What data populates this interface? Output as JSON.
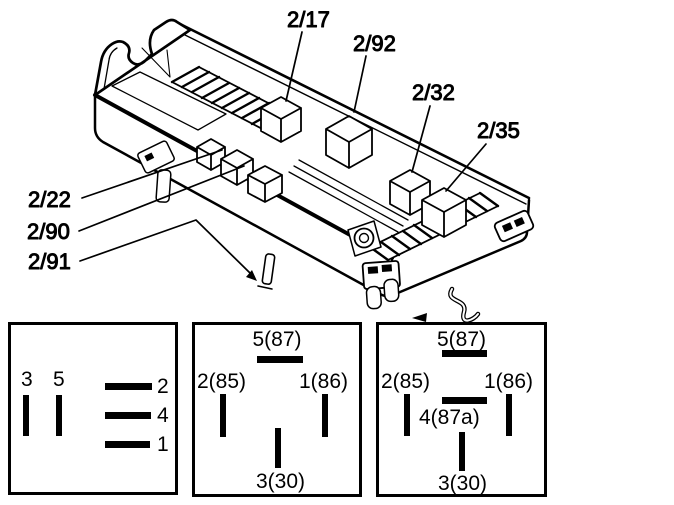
{
  "figure": {
    "type": "relay-box-diagram",
    "background": "#ffffff",
    "line_color": "#000000"
  },
  "callouts": [
    {
      "label": "2/17"
    },
    {
      "label": "2/92"
    },
    {
      "label": "2/32"
    },
    {
      "label": "2/35"
    },
    {
      "label": "2/22"
    },
    {
      "label": "2/90"
    },
    {
      "label": "2/91"
    }
  ],
  "pinouts": [
    {
      "name": "pin-profile-socket",
      "left_pins": [
        "3",
        "5"
      ],
      "right_pins": [
        "2",
        "4",
        "1"
      ]
    },
    {
      "name": "relay-base-4-pin",
      "top": "5(87)",
      "left": "2(85)",
      "right": "1(86)",
      "bottom": "3(30)"
    },
    {
      "name": "relay-base-5-pin",
      "top": "5(87)",
      "left": "2(85)",
      "right": "1(86)",
      "middle": "4(87a)",
      "bottom": "3(30)"
    }
  ]
}
